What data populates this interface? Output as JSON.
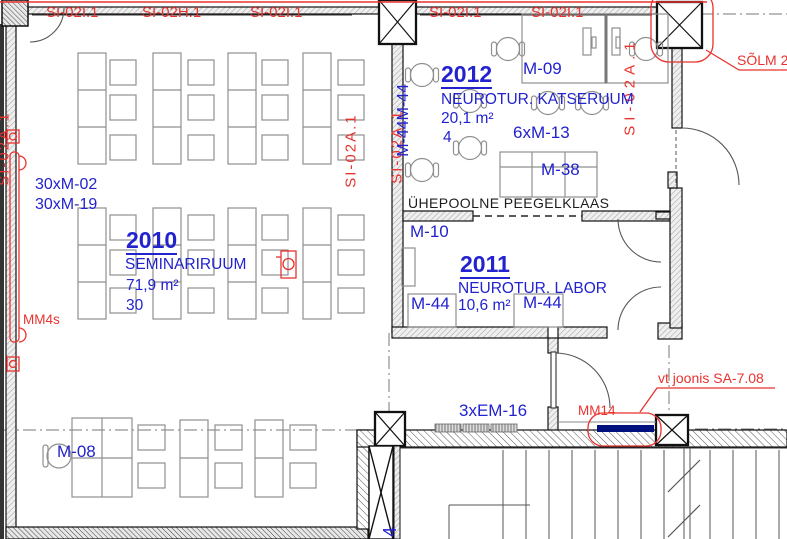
{
  "tags": {
    "si02i_1a": "SI-02I.1",
    "si02h_1": "SI-02H.1",
    "si02i_1b": "SI-02I.1",
    "si02i_1c": "SI-02I.1",
    "si02i_1d": "SI-02I.1",
    "si02a_left": "SI-02A.1",
    "si02a_mid_left": "SI-02A.1",
    "si02a_mid_right": "SI-02A.1",
    "si02a_right": "SI-02A.1"
  },
  "room2010": {
    "number": "2010",
    "name": "SEMINARIRUUM",
    "area": "71,9 m²",
    "capacity": "30",
    "chairs_tag": "30xM-02",
    "desks_tag": "30xM-19",
    "teacher_desk_tag": "M-08"
  },
  "room2011": {
    "number": "2011",
    "name": "NEUROTUR. LABOR",
    "area": "10,6 m²",
    "cabinet_tag": "M-10",
    "table_left_tag": "M-44",
    "table_right_tag": "M-44"
  },
  "room2012": {
    "number": "2012",
    "name": "NEUROTUR. KATSERUUM",
    "area": "20,1 m²",
    "capacity": "4",
    "workstation_tag": "M-09",
    "chairs_tag": "6xM-13",
    "table_tag": "M-38",
    "side_tables_tag": "M-44M-44"
  },
  "annotations": {
    "glass_note": "ÜHEPOOLNE PEEGELKLAAS",
    "mm4s": "MM4s",
    "mm14": "MM14",
    "em16": "3xEM-16",
    "detail_ref": "vt joonis SA-7.08",
    "node_ref": "SÕLM 2",
    "stair_tag": "4"
  },
  "colors": {
    "annotation_red": "#e8332f",
    "annotation_blue": "#2222cf",
    "line_dark": "#1a1a1a",
    "furniture_gray": "#8f8f8f",
    "mm14_bar": "#00107d"
  }
}
